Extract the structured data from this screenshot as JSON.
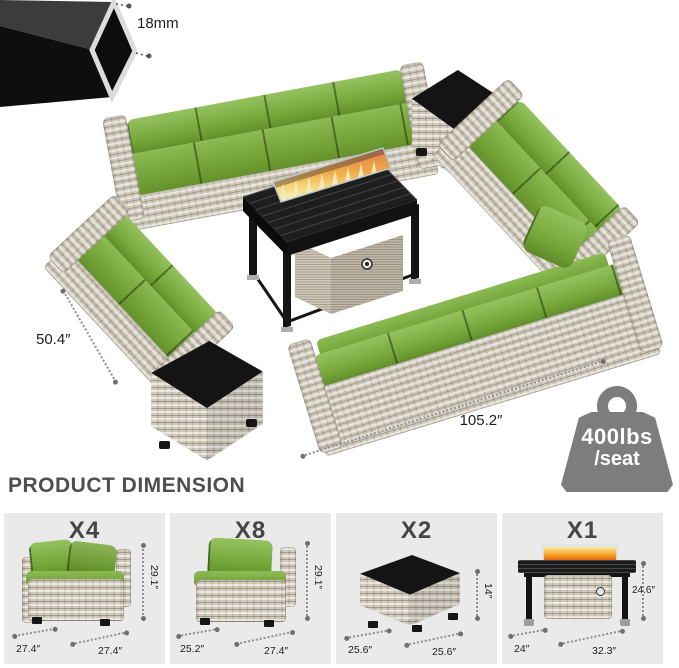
{
  "frame_detail": {
    "tube_size_label": "18mm"
  },
  "scene": {
    "depth_label": "50.4″",
    "width_label": "105.2″",
    "weight_badge": {
      "line1": "400lbs",
      "line2": "/seat"
    }
  },
  "section_heading": "PRODUCT DIMENSION",
  "products": [
    {
      "qty": "X4",
      "dim_left": "27.4″",
      "dim_right": "27.4″",
      "dim_height": "29.1″"
    },
    {
      "qty": "X8",
      "dim_left": "25.2″",
      "dim_right": "27.4″",
      "dim_height": "29.1″"
    },
    {
      "qty": "X2",
      "dim_left": "25.6″",
      "dim_right": "25.6″",
      "dim_height": "14″"
    },
    {
      "qty": "X1",
      "dim_left": "24″",
      "dim_right": "32.3″",
      "dim_height": "24.6″"
    }
  ],
  "icons": {
    "weight_badge": "kettlebell-weight-icon"
  },
  "colors": {
    "cushion_green": "#79a83d",
    "wicker_gray": "#d2ccbf",
    "badge_gray": "#7d7d7d",
    "flame_orange": "#f29b1d",
    "glass_top_black": "#141414"
  }
}
